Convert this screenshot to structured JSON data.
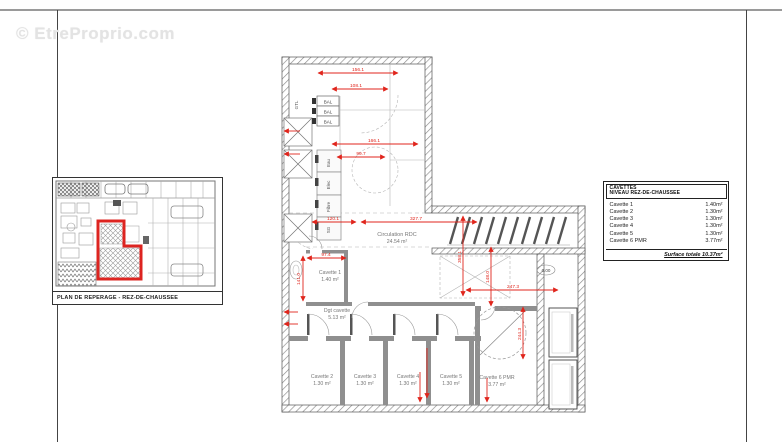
{
  "watermark": "© EtreProprio.com",
  "overview": {
    "caption": "PLAN DE REPERAGE - REZ-DE-CHAUSSEE"
  },
  "legend": {
    "title1": "CAVETTES",
    "title2": "NIVEAU REZ-DE-CHAUSSEE",
    "rows": [
      {
        "label": "Cavette 1",
        "area": "1.40m²"
      },
      {
        "label": "Cavette 2",
        "area": "1.30m²"
      },
      {
        "label": "Cavette 3",
        "area": "1.30m²"
      },
      {
        "label": "Cavette 4",
        "area": "1.30m²"
      },
      {
        "label": "Cavette 5",
        "area": "1.30m²"
      },
      {
        "label": "Cavette 6 PMR",
        "area": "3.77m²"
      }
    ],
    "total_label": "Surface totale 10.37m²"
  },
  "plan": {
    "rooms": {
      "circulation": {
        "name": "Circulation RDC",
        "area": "24.54 m²"
      },
      "cavette1": {
        "name": "Cavette 1",
        "area": "1.40 m²"
      },
      "dgt": {
        "name": "Dgt cavette",
        "area": "5.13 m²"
      },
      "cavette2": {
        "name": "Cavette 2",
        "area": "1.30 m²"
      },
      "cavette3": {
        "name": "Cavette 3",
        "area": "1.30 m²"
      },
      "cavette4": {
        "name": "Cavette 4",
        "area": "1.30 m²"
      },
      "cavette5": {
        "name": "Cavette 5",
        "area": "1.30 m²"
      },
      "cavette6": {
        "name": "Cavette 6 PMR",
        "area": "3.77 m²"
      }
    },
    "labels": {
      "bal": "BAL",
      "gtl": "GTL",
      "eau": "Eau",
      "elec": "Elec",
      "fibre": "Fibre",
      "sg": "SG",
      "level": "0.00"
    },
    "dims": [
      "156.1",
      "108.1",
      "166.1",
      "99.7",
      "120.1",
      "327.7",
      "97.4",
      "141.0",
      "358.1",
      "148.0",
      "247.3",
      "244.3"
    ]
  },
  "colors": {
    "dimension_red": "#e0251c",
    "wall_gray": "#8f8f8f"
  }
}
